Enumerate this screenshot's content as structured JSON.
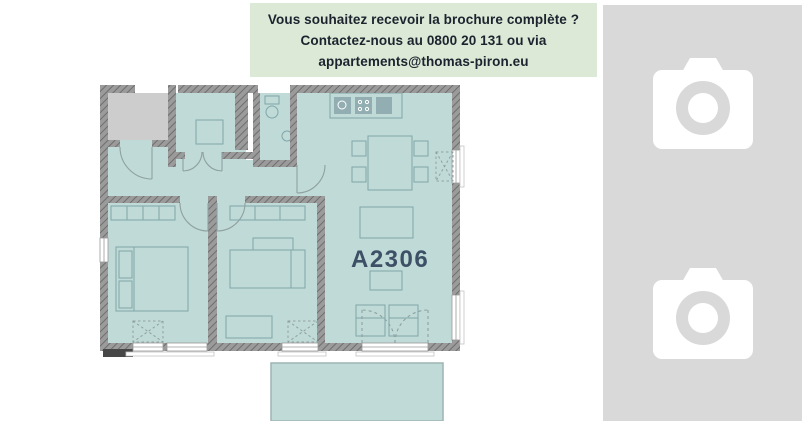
{
  "banner": {
    "line1": "Vous souhaitez recevoir la brochure complète ?",
    "line2": "Contactez-nous au 0800 20 131 ou via",
    "line3": "appartements@thomas-piron.eu",
    "phone": "0800 20 131",
    "email": "appartements@thomas-piron.eu",
    "bg_color": "#dbe9d6",
    "text_color": "#1c222e"
  },
  "floorplan": {
    "unit_label": "A2306",
    "label_color": "#3d5066",
    "interior_color": "#c0dad7",
    "terrace_color": "#c0dad7",
    "common_area_color": "#cdcdcd",
    "wall_color": "#909090",
    "furniture_line_color": "#7fa7aa"
  },
  "gallery": {
    "bg_color": "#d9d9d9",
    "icon_color": "#ffffff",
    "placeholders": [
      {
        "label": "photo-placeholder-1",
        "icon": "camera-icon"
      },
      {
        "label": "photo-placeholder-2",
        "icon": "camera-icon"
      }
    ]
  }
}
